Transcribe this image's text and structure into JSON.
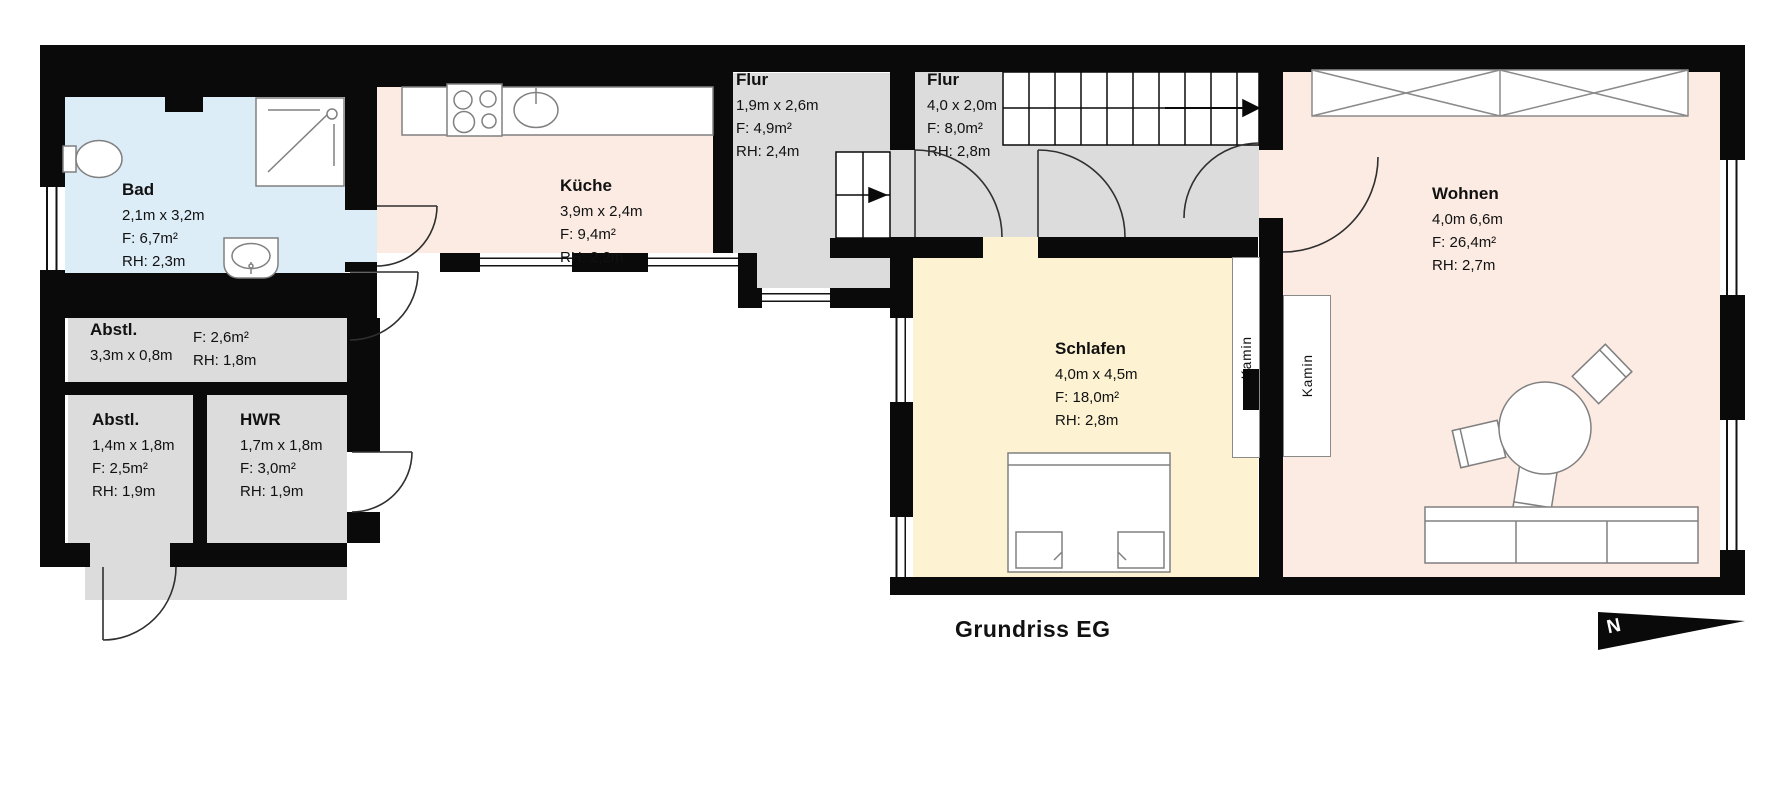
{
  "title": "Grundriss EG",
  "north_indicator": {
    "label": "N"
  },
  "rooms": {
    "bad": {
      "name": "Bad",
      "dims": "2,1m x 3,2m",
      "area": "F: 6,7m²",
      "height": "RH: 2,3m"
    },
    "kueche": {
      "name": "Küche",
      "dims": "3,9m x 2,4m",
      "area": "F: 9,4m²",
      "height": "RH: 2,2m"
    },
    "flur1": {
      "name": "Flur",
      "dims": "1,9m x 2,6m",
      "area": "F: 4,9m²",
      "height": "RH: 2,4m"
    },
    "flur2": {
      "name": "Flur",
      "dims": "4,0 x 2,0m",
      "area": "F: 8,0m²",
      "height": "RH: 2,8m"
    },
    "wohnen": {
      "name": "Wohnen",
      "dims": "4,0m 6,6m",
      "area": "F: 26,4m²",
      "height": "RH: 2,7m"
    },
    "schlafen": {
      "name": "Schlafen",
      "dims": "4,0m x 4,5m",
      "area": "F: 18,0m²",
      "height": "RH: 2,8m"
    },
    "abstl1": {
      "name": "Abstl.",
      "dims": "3,3m x 0,8m",
      "area": "F: 2,6m²",
      "height": "RH: 1,8m"
    },
    "abstl2": {
      "name": "Abstl.",
      "dims": "1,4m x 1,8m",
      "area": "F: 2,5m²",
      "height": "RH: 1,9m"
    },
    "hwr": {
      "name": "HWR",
      "dims": "1,7m x 1,8m",
      "area": "F: 3,0m²",
      "height": "RH: 1,9m"
    }
  },
  "annotations": {
    "kamin1": "Kamin",
    "kamin2": "Kamin"
  },
  "colors": {
    "bath": "#ddedf8",
    "kitchen_living": "#fcebe3",
    "hall": "#dcdcdc",
    "bedroom": "#fdf3d2",
    "wall": "#0a0a0a"
  }
}
